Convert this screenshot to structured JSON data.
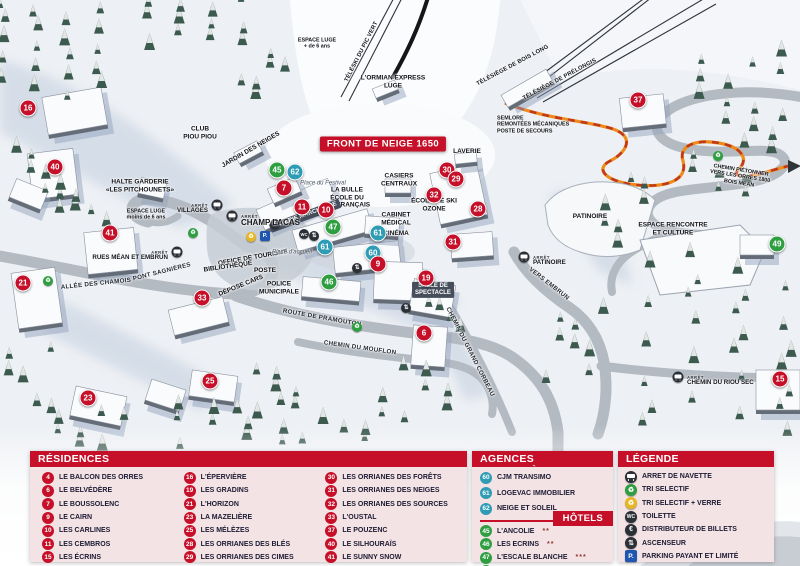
{
  "map": {
    "banner_label": "FRONT DE NEIGE 1650",
    "colors": {
      "residence": "#c60f28",
      "hotel": "#2f9e41",
      "agency": "#2d9cb4"
    },
    "markers": [
      {
        "num": "16",
        "type": "residence",
        "x": 28,
        "y": 108
      },
      {
        "num": "40",
        "type": "residence",
        "x": 55,
        "y": 167
      },
      {
        "num": "41",
        "type": "residence",
        "x": 110,
        "y": 233
      },
      {
        "num": "21",
        "type": "residence",
        "x": 23,
        "y": 283
      },
      {
        "num": "33",
        "type": "residence",
        "x": 202,
        "y": 298
      },
      {
        "num": "23",
        "type": "residence",
        "x": 88,
        "y": 398
      },
      {
        "num": "25",
        "type": "residence",
        "x": 210,
        "y": 381
      },
      {
        "num": "45",
        "type": "hotel",
        "x": 277,
        "y": 170
      },
      {
        "num": "62",
        "type": "agency",
        "x": 295,
        "y": 172
      },
      {
        "num": "7",
        "type": "residence",
        "x": 284,
        "y": 188
      },
      {
        "num": "11",
        "type": "residence",
        "x": 302,
        "y": 207
      },
      {
        "num": "10",
        "type": "residence",
        "x": 326,
        "y": 210
      },
      {
        "num": "47",
        "type": "hotel",
        "x": 333,
        "y": 227
      },
      {
        "num": "61",
        "type": "agency",
        "x": 325,
        "y": 247
      },
      {
        "num": "61",
        "type": "agency",
        "x": 378,
        "y": 233
      },
      {
        "num": "60",
        "type": "agency",
        "x": 373,
        "y": 253
      },
      {
        "num": "9",
        "type": "residence",
        "x": 378,
        "y": 264
      },
      {
        "num": "46",
        "type": "hotel",
        "x": 329,
        "y": 282
      },
      {
        "num": "19",
        "type": "residence",
        "x": 426,
        "y": 278
      },
      {
        "num": "6",
        "type": "residence",
        "x": 424,
        "y": 333
      },
      {
        "num": "30",
        "type": "residence",
        "x": 447,
        "y": 170
      },
      {
        "num": "29",
        "type": "residence",
        "x": 456,
        "y": 179
      },
      {
        "num": "32",
        "type": "residence",
        "x": 434,
        "y": 195
      },
      {
        "num": "28",
        "type": "residence",
        "x": 478,
        "y": 209
      },
      {
        "num": "31",
        "type": "residence",
        "x": 453,
        "y": 242
      },
      {
        "num": "37",
        "type": "residence",
        "x": 638,
        "y": 100
      },
      {
        "num": "49",
        "type": "hotel",
        "x": 777,
        "y": 244
      },
      {
        "num": "15",
        "type": "residence",
        "x": 780,
        "y": 379
      }
    ],
    "labels": [
      {
        "id": "espace-luge-plus",
        "lines": [
          "ESPACE LUGE",
          "+ de 6 ans"
        ],
        "x": 317,
        "y": 44,
        "cls": "tiny"
      },
      {
        "id": "teleski-pic-vert",
        "lines": [
          "TÉLÉSKI DU PIC VERT"
        ],
        "x": 362,
        "y": 52,
        "rot": -63,
        "cls": "lift"
      },
      {
        "id": "telesiege-bois-long",
        "lines": [
          "TÉLÉSIÈGE DE BOIS LONG"
        ],
        "x": 513,
        "y": 66,
        "rot": -28,
        "cls": "lift"
      },
      {
        "id": "telesiege-prelongis",
        "lines": [
          "TÉLÉSIÈGE DE PRÉLONGIS"
        ],
        "x": 560,
        "y": 80,
        "rot": -28,
        "cls": "lift"
      },
      {
        "id": "ormian-express-luge",
        "lines": [
          "L'ORMIAN EXPRESS",
          "LUGE"
        ],
        "x": 393,
        "y": 82,
        "cls": ""
      },
      {
        "id": "semlore",
        "lines": [
          "SEMLORE",
          "REMONTÉES MÉCANIQUES",
          "POSTE DE SECOURS"
        ],
        "x": 497,
        "y": 125,
        "cls": "boldleft tiny"
      },
      {
        "id": "laverie",
        "lines": [
          "LAVERIE"
        ],
        "x": 467,
        "y": 152,
        "cls": ""
      },
      {
        "id": "casiers-centraux",
        "lines": [
          "CASIERS",
          "CENTRAUX"
        ],
        "x": 399,
        "y": 180,
        "cls": ""
      },
      {
        "id": "la-bulle-esf",
        "lines": [
          "LA BULLE",
          "ÉCOLE DU",
          "SKI FRANÇAIS"
        ],
        "x": 347,
        "y": 198,
        "cls": ""
      },
      {
        "id": "place-du-festival",
        "lines": [
          "Place du Festival"
        ],
        "x": 323,
        "y": 184,
        "cls": "italic"
      },
      {
        "id": "ecole-ski-ozone",
        "lines": [
          "ÉCOLE DE SKI",
          "OZONE"
        ],
        "x": 434,
        "y": 205,
        "cls": ""
      },
      {
        "id": "cabinet-medical",
        "lines": [
          "CABINET",
          "MÉDICAL"
        ],
        "x": 396,
        "y": 219,
        "cls": ""
      },
      {
        "id": "cinema",
        "lines": [
          "CINÉMA"
        ],
        "x": 396,
        "y": 234,
        "cls": ""
      },
      {
        "id": "galerie-marchande",
        "lines": [
          "GALERIE MARCHANDE"
        ],
        "x": 305,
        "y": 216,
        "rot": -20,
        "cls": "onbldg"
      },
      {
        "id": "halte-garderie",
        "lines": [
          "HALTE GARDERIE",
          "«LES PITCHOUNETS»"
        ],
        "x": 140,
        "y": 186,
        "cls": ""
      },
      {
        "id": "club-piou-piou",
        "lines": [
          "CLUB",
          "PIOU PIOU"
        ],
        "x": 200,
        "y": 133,
        "cls": ""
      },
      {
        "id": "jardin-des-neiges",
        "lines": [
          "JARDIN DES NEIGES"
        ],
        "x": 251,
        "y": 150,
        "rot": -30,
        "cls": ""
      },
      {
        "id": "espace-luge-moins",
        "lines": [
          "ESPACE LUGE",
          "moins de 6 ans"
        ],
        "x": 146,
        "y": 215,
        "cls": "tiny"
      },
      {
        "id": "office-de-tourisme",
        "lines": [
          "OFFICE DE TOURISME"
        ],
        "x": 253,
        "y": 258,
        "rot": -10,
        "cls": ""
      },
      {
        "id": "bibliotheque",
        "lines": [
          "BIBLIOTHÈQUE"
        ],
        "x": 228,
        "y": 267,
        "rot": -8,
        "cls": ""
      },
      {
        "id": "poste",
        "lines": [
          "POSTE"
        ],
        "x": 265,
        "y": 271,
        "cls": ""
      },
      {
        "id": "depose-cars",
        "lines": [
          "DÉPOSE CARS"
        ],
        "x": 241,
        "y": 286,
        "rot": -22,
        "cls": ""
      },
      {
        "id": "police-municipale",
        "lines": [
          "POLICE",
          "MUNICIPALE"
        ],
        "x": 279,
        "y": 288,
        "cls": ""
      },
      {
        "id": "place-accueil",
        "lines": [
          "Place d'accueil"
        ],
        "x": 292,
        "y": 253,
        "cls": "italic"
      },
      {
        "id": "pont-sagnieres",
        "lines": [
          "PONT SAGNIÈRES"
        ],
        "x": 162,
        "y": 272,
        "rot": -14,
        "cls": "road"
      },
      {
        "id": "allee-des-chamois",
        "lines": [
          "ALLÉE DES CHAMOIS"
        ],
        "x": 96,
        "y": 284,
        "rot": -6,
        "cls": "road"
      },
      {
        "id": "route-de-pramouton",
        "lines": [
          "ROUTE DE PRAMOUTON"
        ],
        "x": 322,
        "y": 318,
        "rot": 10,
        "cls": "road"
      },
      {
        "id": "chemin-du-mouflon",
        "lines": [
          "CHEMIN DU MOUFLON"
        ],
        "x": 360,
        "y": 348,
        "rot": 8,
        "cls": "road"
      },
      {
        "id": "chemin-du-grand-corbeau",
        "lines": [
          "CHEMIN DU GRAND CORBEAU"
        ],
        "x": 470,
        "y": 352,
        "rot": 63,
        "cls": "road"
      },
      {
        "id": "vers-embrun",
        "lines": [
          "VERS EMBRUN"
        ],
        "x": 549,
        "y": 284,
        "rot": 38,
        "cls": "road"
      },
      {
        "id": "salle-de-spectacle",
        "lines": [
          "SALLE DE",
          "SPECTACLE"
        ],
        "x": 433,
        "y": 290,
        "cls": "onbldg"
      },
      {
        "id": "patinoire",
        "lines": [
          "PATINOIRE"
        ],
        "x": 590,
        "y": 217,
        "cls": ""
      },
      {
        "id": "espace-rencontre",
        "lines": [
          "ESPACE RENCONTRE",
          "ET CULTURE"
        ],
        "x": 673,
        "y": 229,
        "cls": ""
      },
      {
        "id": "chemin-pietonnier",
        "lines": [
          "CHEMIN PIÉTONNIER",
          "VERS LES ORRES 1800",
          "BOIS MÉAN"
        ],
        "x": 740,
        "y": 177,
        "rot": 9,
        "cls": "tiny"
      }
    ],
    "bus_stops": [
      {
        "label": "VILLAGES",
        "x": 217,
        "y": 205,
        "side": "left",
        "arret": "ARRÊT"
      },
      {
        "label": "CHAMP LACAS",
        "x": 232,
        "y": 216,
        "side": "right",
        "arret": "ARRÊT",
        "big": true
      },
      {
        "label": "RUES MÉAN ET EMBRUN",
        "x": 177,
        "y": 252,
        "side": "left",
        "arret": "ARRÊT"
      },
      {
        "label": "PATINOIRE",
        "x": 524,
        "y": 257,
        "side": "right",
        "arret": "ARRÊT"
      },
      {
        "label": "CHEMIN DU RIOU SEC",
        "x": 678,
        "y": 377,
        "side": "right",
        "arret": "ARRÊT"
      }
    ],
    "icons": [
      {
        "type": "recycle-green",
        "x": 48,
        "y": 281
      },
      {
        "type": "recycle-green",
        "x": 193,
        "y": 233
      },
      {
        "type": "recycle-green",
        "x": 357,
        "y": 327
      },
      {
        "type": "recycle-green",
        "x": 718,
        "y": 156
      },
      {
        "type": "recycle-yellow",
        "x": 251,
        "y": 237
      },
      {
        "type": "parking",
        "x": 265,
        "y": 236
      },
      {
        "type": "euro",
        "x": 275,
        "y": 224
      },
      {
        "type": "toilet",
        "x": 304,
        "y": 234
      },
      {
        "type": "elevator",
        "x": 314,
        "y": 236
      },
      {
        "type": "elevator",
        "x": 357,
        "y": 268
      },
      {
        "type": "elevator",
        "x": 406,
        "y": 308
      }
    ]
  },
  "panels": {
    "residences": {
      "title": "RÉSIDENCES",
      "items": [
        {
          "num": "4",
          "label": "LE BALCON DES ORRES"
        },
        {
          "num": "6",
          "label": "LE BELVÉDÈRE"
        },
        {
          "num": "7",
          "label": "LE BOUSSOLENC"
        },
        {
          "num": "9",
          "label": "LE CAIRN"
        },
        {
          "num": "10",
          "label": "LES CARLINES"
        },
        {
          "num": "11",
          "label": "LES CEMBROS"
        },
        {
          "num": "15",
          "label": "LES ÉCRINS"
        },
        {
          "num": "16",
          "label": "L'ÉPERVIÈRE"
        },
        {
          "num": "19",
          "label": "LES GRADINS"
        },
        {
          "num": "21",
          "label": "L'HORIZON"
        },
        {
          "num": "23",
          "label": "LA MAZELIÈRE"
        },
        {
          "num": "25",
          "label": "LES MÉLÈZES"
        },
        {
          "num": "28",
          "label": "LES ORRIANES DES BLÉS"
        },
        {
          "num": "29",
          "label": "LES ORRIANES DES CIMES"
        },
        {
          "num": "30",
          "label": "LES ORRIANES DES FORÊTS"
        },
        {
          "num": "31",
          "label": "LES ORRIANES DES NEIGES"
        },
        {
          "num": "32",
          "label": "LES ORRIANES DES SOURCES"
        },
        {
          "num": "33",
          "label": "L'OUSTAL"
        },
        {
          "num": "37",
          "label": "LE POUZENC"
        },
        {
          "num": "40",
          "label": "LE SILHOURAÏS"
        },
        {
          "num": "41",
          "label": "LE SUNNY SNOW"
        }
      ]
    },
    "agences": {
      "title": "AGENCES IMMOBILIÈRES",
      "items": [
        {
          "num": "60",
          "label": "CJM TRANSIMO"
        },
        {
          "num": "61",
          "label": "LOGEVAC IMMOBILIER"
        },
        {
          "num": "62",
          "label": "NEIGE ET SOLEIL"
        }
      ]
    },
    "hotels": {
      "title": "HÔTELS",
      "items": [
        {
          "num": "45",
          "label": "L'ANCOLIE",
          "stars": "**"
        },
        {
          "num": "46",
          "label": "LES ECRINS",
          "stars": "**"
        },
        {
          "num": "47",
          "label": "L'ESCALE BLANCHE",
          "stars": "***"
        },
        {
          "num": "49",
          "label": "LES TRAPPEURS",
          "stars": "**"
        }
      ]
    },
    "legende": {
      "title": "LÉGENDE",
      "items": [
        {
          "icon": "bus",
          "label": "ARRET DE NAVETTE"
        },
        {
          "icon": "recycle-green",
          "label": "TRI SELECTIF"
        },
        {
          "icon": "recycle-yellow",
          "label": "TRI SELECTIF + VERRE"
        },
        {
          "icon": "toilet",
          "label": "TOILETTE"
        },
        {
          "icon": "euro",
          "label": "DISTRIBUTEUR DE BILLETS"
        },
        {
          "icon": "elevator",
          "label": "ASCENSEUR"
        },
        {
          "icon": "parking",
          "label": "PARKING PAYANT ET LIMITÉ"
        }
      ]
    }
  }
}
